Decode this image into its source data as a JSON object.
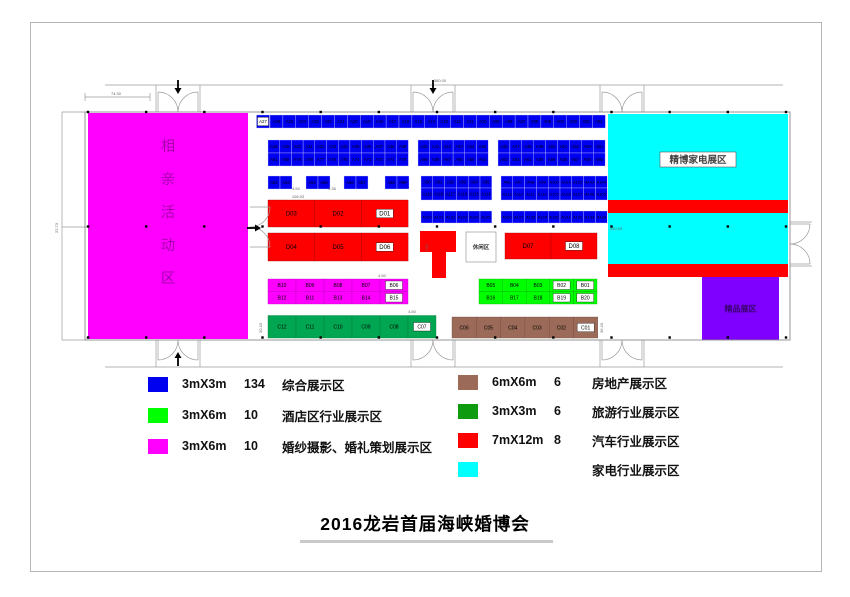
{
  "page": {
    "title": "2016龙岩首届海峡婚博会"
  },
  "legend": {
    "left": [
      {
        "color": "#0000f0",
        "size": "3mX3m",
        "count": "134",
        "label": "综合展示区"
      },
      {
        "color": "#00ff00",
        "size": "3mX6m",
        "count": "10",
        "label": "酒店区行业展示区"
      },
      {
        "color": "#ff00ff",
        "size": "3mX6m",
        "count": "10",
        "label": "婚纱摄影、婚礼策划展示区"
      }
    ],
    "right": [
      {
        "color": "#9b6a58",
        "size": "6mX6m",
        "count": "6",
        "label": "房地产展示区"
      },
      {
        "color": "#0f9b0f",
        "size": "3mX3m",
        "count": "6",
        "label": "旅游行业展示区"
      },
      {
        "color": "#ff0000",
        "size": "7mX12m",
        "count": "8",
        "label": "汽车行业展示区"
      },
      {
        "color": "#00ffff",
        "size": "",
        "count": "",
        "label": "家电行业展示区"
      }
    ]
  },
  "floorplan": {
    "hall": {
      "x": 85,
      "y": 112,
      "w": 705,
      "h": 228,
      "stroke": "#8a8a8a"
    },
    "zones": [
      {
        "name": "matchmaking-hall",
        "x": 88,
        "y": 113,
        "w": 160,
        "h": 226,
        "color": "#ff00ff",
        "label": "相亲活动区",
        "label_mode": "vertical",
        "label_color": "rgba(90,0,100,0.55)",
        "label_size": 14
      },
      {
        "name": "appliance-zone-upper",
        "x": 608,
        "y": 114,
        "w": 180,
        "h": 86,
        "color": "#00ffff"
      },
      {
        "name": "red-stripe-1",
        "x": 608,
        "y": 200,
        "w": 180,
        "h": 13,
        "color": "#ff0000"
      },
      {
        "name": "appliance-zone-lower",
        "x": 608,
        "y": 213,
        "w": 180,
        "h": 51,
        "color": "#00ffff"
      },
      {
        "name": "red-stripe-2",
        "x": 608,
        "y": 264,
        "w": 180,
        "h": 13,
        "color": "#ff0000"
      },
      {
        "name": "purple-zone",
        "x": 702,
        "y": 277,
        "w": 77,
        "h": 63,
        "color": "#7f00ff",
        "label": "精品展区",
        "label_mode": "center",
        "label_color": "rgba(40,0,70,0.8)",
        "label_size": 8
      },
      {
        "name": "stage-bar",
        "x": 420,
        "y": 231,
        "w": 36,
        "h": 21,
        "color": "#ff0000"
      },
      {
        "name": "stage-stem",
        "x": 432,
        "y": 252,
        "w": 14,
        "h": 26,
        "color": "#ff0000"
      },
      {
        "name": "rest-area",
        "x": 466,
        "y": 232,
        "w": 30,
        "h": 30,
        "color": "#ffffff",
        "stroke": "#888",
        "label": "休闲区",
        "label_mode": "center",
        "label_color": "#333",
        "label_size": 5.5
      },
      {
        "name": "appliance-label-box",
        "x": 660,
        "y": 152,
        "w": 76,
        "h": 15,
        "color": "#ffffff",
        "stroke": "#555",
        "label": "精博家电展区",
        "label_mode": "center",
        "label_color": "#444",
        "label_size": 9.5
      }
    ],
    "boxed_labels": [
      "A27",
      "D01",
      "D06",
      "D08",
      "B06",
      "B15",
      "B02",
      "B01",
      "B19",
      "B20",
      "C07",
      "C01"
    ],
    "booth_groups": [
      {
        "x": 256.5,
        "y": 115,
        "cw": 13,
        "ch": 13,
        "fs": 4.3,
        "color": "#0000f0",
        "sc": "#c8c8ff",
        "rows": [
          [
            "A27"
          ]
        ]
      },
      {
        "x": 270,
        "y": 115,
        "cw": 12.9,
        "ch": 13,
        "fs": 4.2,
        "color": "#0000f0",
        "sc": "#c8c8ff",
        "rows": [
          [
            "A26",
            "A25",
            "A24",
            "A23",
            "A22",
            "A21",
            "A20",
            "A19",
            "A18",
            "A17",
            "A16",
            "A15",
            "A14",
            "A13",
            "A12",
            "A11",
            "A10",
            "A09",
            "A08",
            "A07",
            "A06",
            "A05",
            "A04",
            "A03",
            "A02",
            "A01"
          ]
        ]
      },
      {
        "x": 268,
        "y": 140,
        "cw": 11.7,
        "ch": 13,
        "fs": 4.2,
        "color": "#0000f0",
        "sc": "#c8c8ff",
        "rows": [
          [
            "A28",
            "A29",
            "A30",
            "A31",
            "A32",
            "A33",
            "A34",
            "A35",
            "A36",
            "A37",
            "A38",
            "A39"
          ],
          [
            "A81",
            "A80",
            "A79",
            "A78",
            "A77",
            "A76",
            "A75",
            "A74",
            "A73",
            "A72",
            "A71",
            "A70"
          ]
        ]
      },
      {
        "x": 418,
        "y": 140,
        "cw": 11.7,
        "ch": 13,
        "fs": 4.2,
        "color": "#0000f0",
        "sc": "#c8c8ff",
        "rows": [
          [
            "A40",
            "A41",
            "A42",
            "A43",
            "A44",
            "A45"
          ],
          [
            "A69",
            "A68",
            "A67",
            "A66",
            "A65",
            "A64"
          ]
        ]
      },
      {
        "x": 498,
        "y": 140,
        "cw": 11.9,
        "ch": 13,
        "fs": 4.2,
        "color": "#0000f0",
        "sc": "#c8c8ff",
        "rows": [
          [
            "A46",
            "A47",
            "A48",
            "A49",
            "A50",
            "A51",
            "A52",
            "A53",
            "A54"
          ],
          [
            "A63",
            "A62",
            "A61",
            "A60",
            "A59",
            "A58",
            "A57",
            "A56",
            "A55"
          ]
        ]
      },
      {
        "x": 268,
        "y": 176,
        "cw": 12,
        "ch": 13,
        "fs": 4.2,
        "color": "#0000f0",
        "sc": "#c8c8ff",
        "rows": [
          [
            "A82",
            "A83"
          ]
        ]
      },
      {
        "x": 306,
        "y": 176,
        "cw": 12,
        "ch": 13,
        "fs": 4.2,
        "color": "#0000f0",
        "sc": "#c8c8ff",
        "rows": [
          [
            "A84",
            "A85"
          ]
        ]
      },
      {
        "x": 344,
        "y": 176,
        "cw": 12,
        "ch": 13,
        "fs": 4.2,
        "color": "#0000f0",
        "sc": "#c8c8ff",
        "rows": [
          [
            "A86",
            "A87"
          ]
        ]
      },
      {
        "x": 385,
        "y": 176,
        "cw": 12,
        "ch": 13,
        "fs": 4.2,
        "color": "#0000f0",
        "sc": "#c8c8ff",
        "rows": [
          [
            "A88",
            "A89"
          ]
        ]
      },
      {
        "x": 421,
        "y": 176,
        "cw": 11.8,
        "ch": 12,
        "fs": 4.2,
        "color": "#0000f0",
        "sc": "#c8c8ff",
        "rows": [
          [
            "A90",
            "A91",
            "A92",
            "A93",
            "A94",
            "A95"
          ],
          [
            "A119",
            "A118",
            "A117",
            "A116",
            "A115",
            "A114"
          ]
        ]
      },
      {
        "x": 501,
        "y": 176,
        "cw": 11.8,
        "ch": 12,
        "fs": 4,
        "color": "#0000f0",
        "sc": "#c8c8ff",
        "rows": [
          [
            "A96",
            "A97",
            "A98",
            "A99",
            "A100",
            "A101",
            "A102",
            "A103",
            "A104"
          ],
          [
            "A113",
            "A112",
            "A111",
            "A110",
            "A109",
            "A108",
            "A107",
            "A106",
            "A105"
          ]
        ]
      },
      {
        "x": 421,
        "y": 211,
        "cw": 11.8,
        "ch": 12,
        "fs": 4,
        "color": "#0000f0",
        "sc": "#c8c8ff",
        "rows": [
          [
            "A120",
            "A121",
            "A122",
            "A123",
            "A124",
            "A125"
          ]
        ]
      },
      {
        "x": 501,
        "y": 211,
        "cw": 11.8,
        "ch": 12,
        "fs": 4,
        "color": "#0000f0",
        "sc": "#c8c8ff",
        "rows": [
          [
            "A126",
            "A127",
            "A128",
            "A129",
            "A130",
            "A131",
            "A132",
            "A133",
            "A134"
          ]
        ]
      },
      {
        "x": 268,
        "y": 200,
        "cw": 46.7,
        "ch": 27,
        "fs": 6,
        "color": "#ff0000",
        "sc": "#990000",
        "rows": [
          [
            "D03",
            "D02",
            "D01"
          ]
        ]
      },
      {
        "x": 268,
        "y": 233,
        "cw": 46.7,
        "ch": 28,
        "fs": 6,
        "color": "#ff0000",
        "sc": "#990000",
        "rows": [
          [
            "D04",
            "D05",
            "D06"
          ]
        ]
      },
      {
        "x": 505,
        "y": 233,
        "cw": 46,
        "ch": 26,
        "fs": 6,
        "color": "#ff0000",
        "sc": "#990000",
        "rows": [
          [
            "D07",
            "D08"
          ]
        ]
      },
      {
        "x": 268,
        "y": 279,
        "cw": 28,
        "ch": 12.5,
        "fs": 5,
        "color": "#ff00ff",
        "sc": "#b800b8",
        "rows": [
          [
            "B10",
            "B09",
            "B08",
            "B07",
            "B06"
          ],
          [
            "B12",
            "B11",
            "B13",
            "B14",
            "B15"
          ]
        ]
      },
      {
        "x": 268,
        "y": 315.5,
        "cw": 28,
        "ch": 22.5,
        "fs": 5,
        "color": "#00a651",
        "sc": "#007a33",
        "rows": [
          [
            "C12",
            "C11",
            "C10",
            "C09",
            "C08",
            "C07"
          ]
        ]
      },
      {
        "x": 479,
        "y": 279,
        "cw": 23.6,
        "ch": 12.5,
        "fs": 5,
        "color": "#00ff00",
        "sc": "#00aa00",
        "rows": [
          [
            "B05",
            "B04",
            "B03",
            "B02",
            "B01"
          ],
          [
            "B16",
            "B17",
            "B18",
            "B19",
            "B20"
          ]
        ]
      },
      {
        "x": 452,
        "y": 317,
        "cw": 24.3,
        "ch": 21,
        "fs": 5,
        "color": "#9b6a58",
        "sc": "#6d4a3e",
        "rows": [
          [
            "C06",
            "C05",
            "C04",
            "C03",
            "C02",
            "C01"
          ]
        ]
      }
    ],
    "doors": [
      {
        "cx": 178,
        "y": 112,
        "dir": "up"
      },
      {
        "cx": 433,
        "y": 112,
        "dir": "up"
      },
      {
        "cx": 622,
        "y": 112,
        "dir": "up"
      },
      {
        "cx": 178,
        "y": 340,
        "dir": "down"
      },
      {
        "cx": 433,
        "y": 340,
        "dir": "down"
      },
      {
        "cx": 622,
        "y": 340,
        "dir": "down"
      },
      {
        "x": 790,
        "cy": 244,
        "dir": "right"
      },
      {
        "x": 250,
        "cy": 227,
        "dir": "right"
      }
    ],
    "arrows": [
      {
        "x": 178,
        "y": 88,
        "d": "down"
      },
      {
        "x": 433,
        "y": 88,
        "d": "down"
      },
      {
        "x": 178,
        "y": 358,
        "d": "up"
      },
      {
        "x": 255,
        "y": 228,
        "d": "right"
      }
    ],
    "dot_rows": [
      {
        "y": 112,
        "x1": 88,
        "x2": 786,
        "n": 13
      },
      {
        "y": 226.5,
        "x1": 88,
        "x2": 786,
        "n": 13
      },
      {
        "y": 337.5,
        "x1": 88,
        "x2": 786,
        "n": 13
      }
    ],
    "lines": [
      [
        105,
        85,
        783,
        85
      ],
      [
        105,
        367,
        783,
        367
      ],
      [
        62,
        112,
        62,
        340
      ],
      [
        62,
        112,
        88,
        112
      ],
      [
        62,
        227,
        88,
        227
      ],
      [
        62,
        340,
        88,
        340
      ],
      [
        85,
        97,
        150,
        97
      ],
      [
        85,
        93,
        85,
        101
      ],
      [
        150,
        93,
        150,
        101
      ],
      [
        156,
        85,
        156,
        112
      ],
      [
        200,
        85,
        200,
        112
      ],
      [
        411,
        85,
        411,
        112
      ],
      [
        455,
        85,
        455,
        112
      ],
      [
        600,
        85,
        600,
        112
      ],
      [
        644,
        85,
        644,
        112
      ],
      [
        156,
        340,
        156,
        367
      ],
      [
        200,
        340,
        200,
        367
      ],
      [
        411,
        340,
        411,
        367
      ],
      [
        455,
        340,
        455,
        367
      ],
      [
        600,
        340,
        600,
        367
      ],
      [
        644,
        340,
        644,
        367
      ],
      [
        790,
        222,
        812,
        222
      ],
      [
        790,
        266,
        812,
        266
      ]
    ],
    "dims": [
      {
        "t": "74.30",
        "x": 116,
        "y": 95
      },
      {
        "t": "360.00",
        "x": 440,
        "y": 82
      },
      {
        "t": "22.73",
        "x": 58,
        "y": 228,
        "r": -90
      },
      {
        "t": "4.50",
        "x": 296,
        "y": 190
      },
      {
        "t": "4.36",
        "x": 332,
        "y": 190
      },
      {
        "t": "106.53",
        "x": 298,
        "y": 198
      },
      {
        "t": "4.50",
        "x": 382,
        "y": 277
      },
      {
        "t": "30.43",
        "x": 262,
        "y": 328,
        "r": -90
      },
      {
        "t": "4.50",
        "x": 412,
        "y": 313
      },
      {
        "t": "7.62",
        "x": 428,
        "y": 248,
        "r": -90
      },
      {
        "t": "36.43",
        "x": 603,
        "y": 328,
        "r": -90
      },
      {
        "t": "240.53",
        "x": 616,
        "y": 230
      }
    ]
  }
}
